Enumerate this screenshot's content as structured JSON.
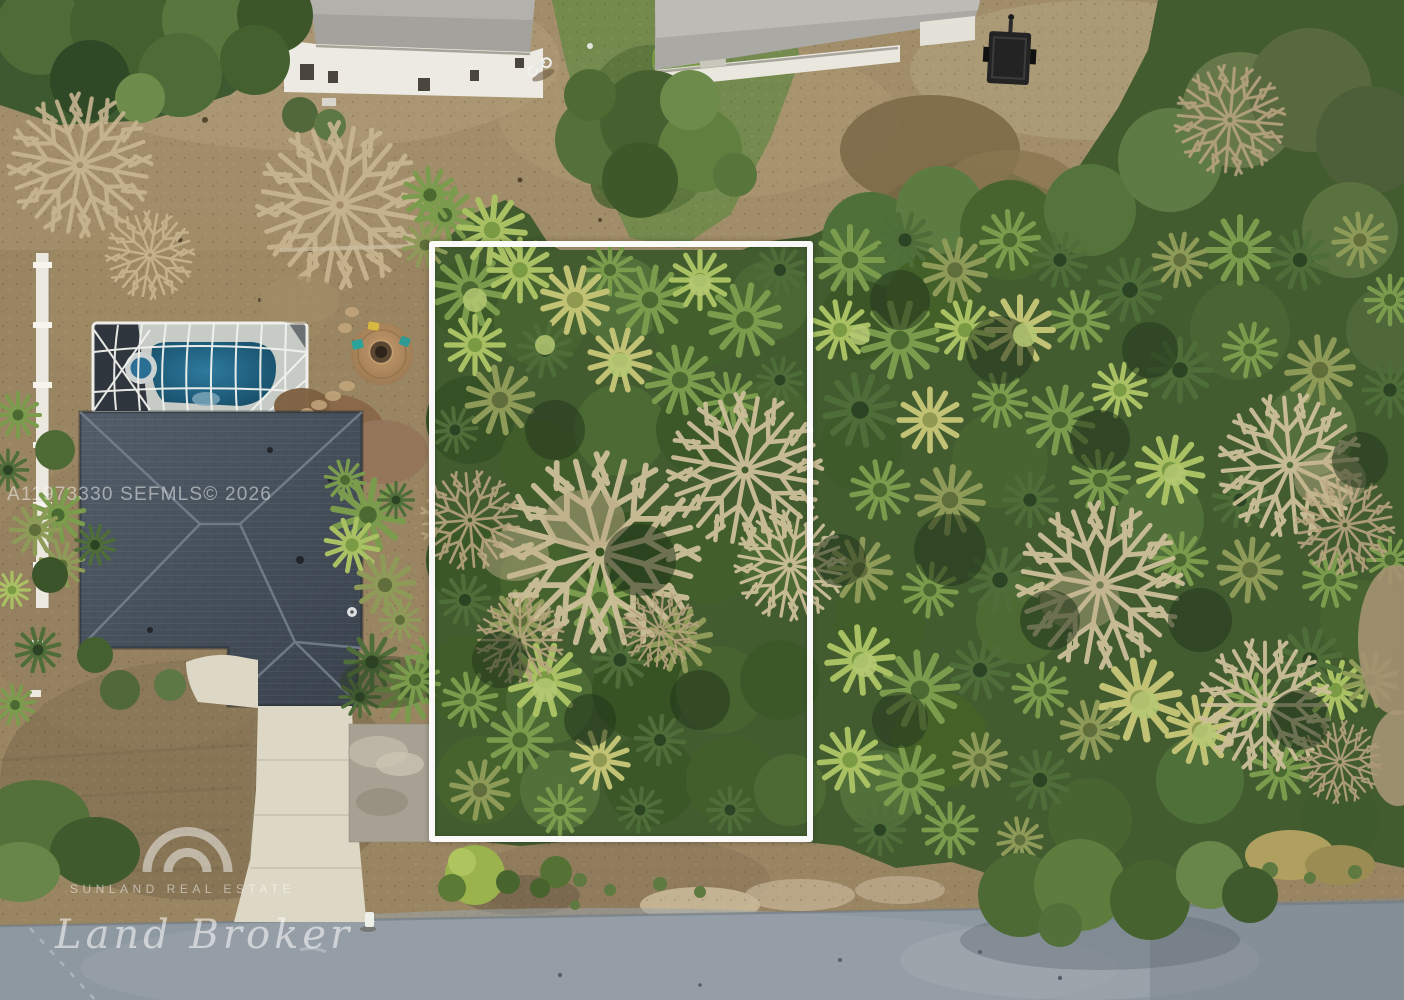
{
  "photo": {
    "type": "aerial-drone-real-estate-photo",
    "subject": "vacant wooded residential lot outlined in white, next to a home with screened pool",
    "features": [
      "neighbor-house-top-left",
      "neighbor-house-top-right",
      "screened-pool-enclosure",
      "paver-fire-pit-patio",
      "gray-shingle-hip-roof",
      "concrete-driveway",
      "white-pvc-fence",
      "black-utility-trailer",
      "dirt-bike",
      "palm-forest",
      "dead-bare-trees",
      "asphalt-road"
    ]
  },
  "overlays": {
    "mls_watermark": "A11973330  SEFMLS© 2026",
    "lot_outline_color": "#ffffff"
  },
  "branding": {
    "agency_name": "SUNLAND REAL ESTATE",
    "brand_script": "Land Broker",
    "logo_icon": "double-arch-icon"
  },
  "palette": {
    "dirt": "#9a8562",
    "dirt_light": "#b3a07c",
    "dirt_dark": "#75634a",
    "grass": "#6f8a4a",
    "forest_base": "#425c30",
    "palm_bright": "#a9c163",
    "palm_green": "#7a9c4c",
    "palm_dark": "#4e6d38",
    "palm_olive": "#8e9a58",
    "palm_yellow": "#c2c275",
    "dead_tree": "#cbbc94",
    "roof": "#46505c",
    "pool": "#1d5b7d",
    "enclosure_frame": "#f3f4f0",
    "driveway": "#ddd7c5",
    "road": "#8e98a1",
    "fence": "#ebe8df",
    "trailer": "#232323"
  }
}
